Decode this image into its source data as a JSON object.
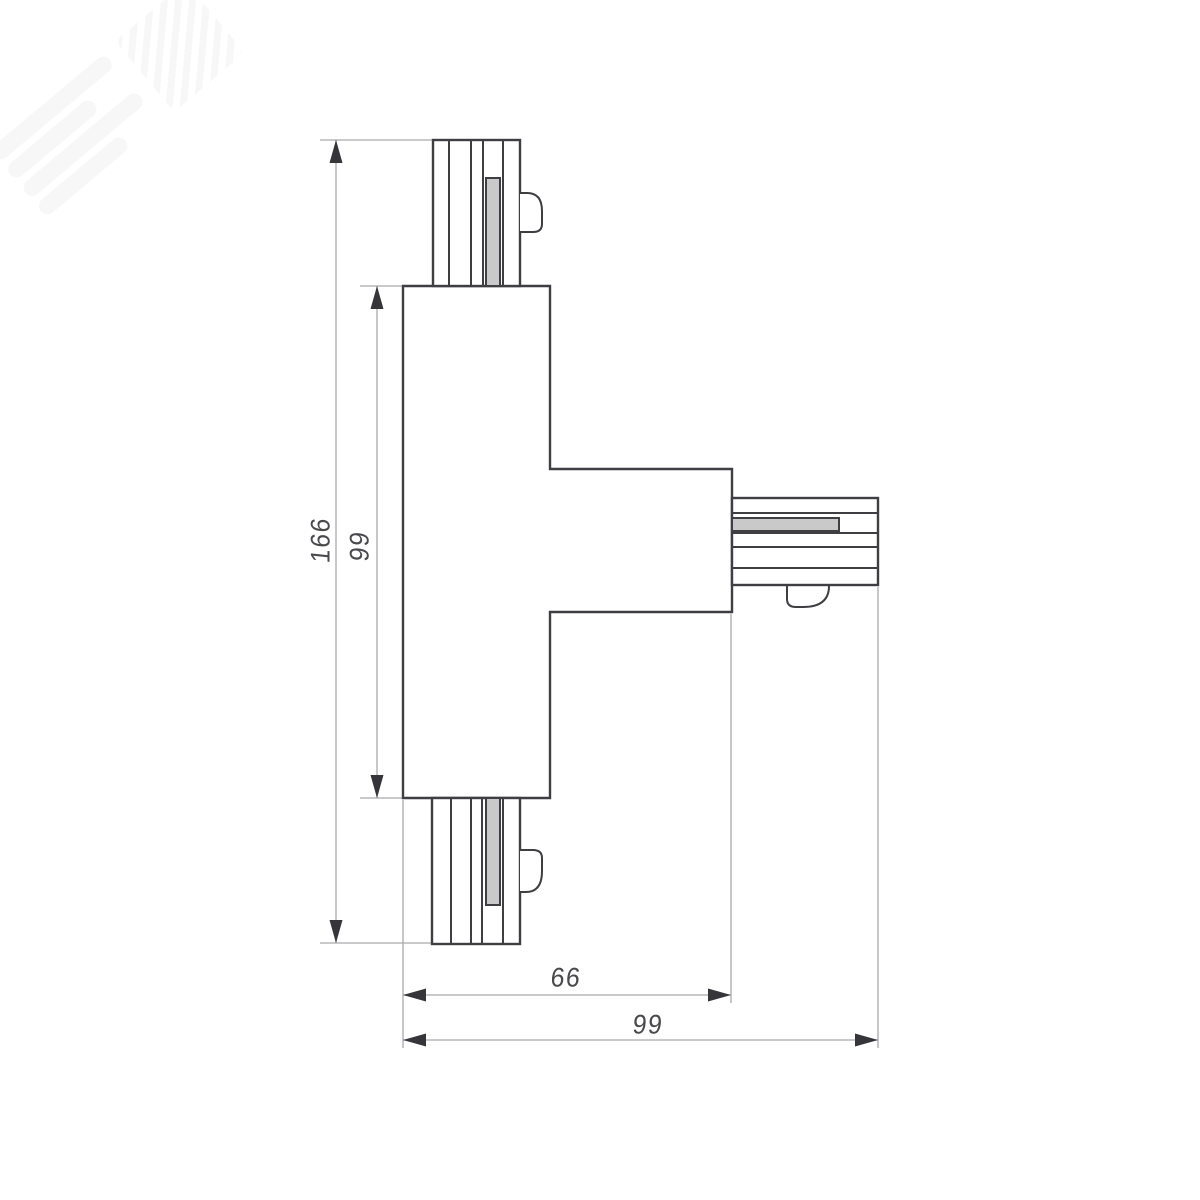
{
  "drawing": {
    "type": "technical-dimension-drawing",
    "dimensions": [
      {
        "label": "166",
        "axis": "vertical",
        "role": "total-height"
      },
      {
        "label": "99",
        "axis": "vertical",
        "role": "body-height"
      },
      {
        "label": "66",
        "axis": "horizontal",
        "role": "body-width"
      },
      {
        "label": "99",
        "axis": "horizontal",
        "role": "total-width"
      }
    ],
    "colors": {
      "background": "#ffffff",
      "outline": "#3e3e43",
      "thin_line": "#a9a9ad",
      "arrow": "#35353a",
      "contact_fill": "#c9c9c9",
      "label_text": "#4a4a4e",
      "watermark": "#f2f2f4"
    }
  }
}
